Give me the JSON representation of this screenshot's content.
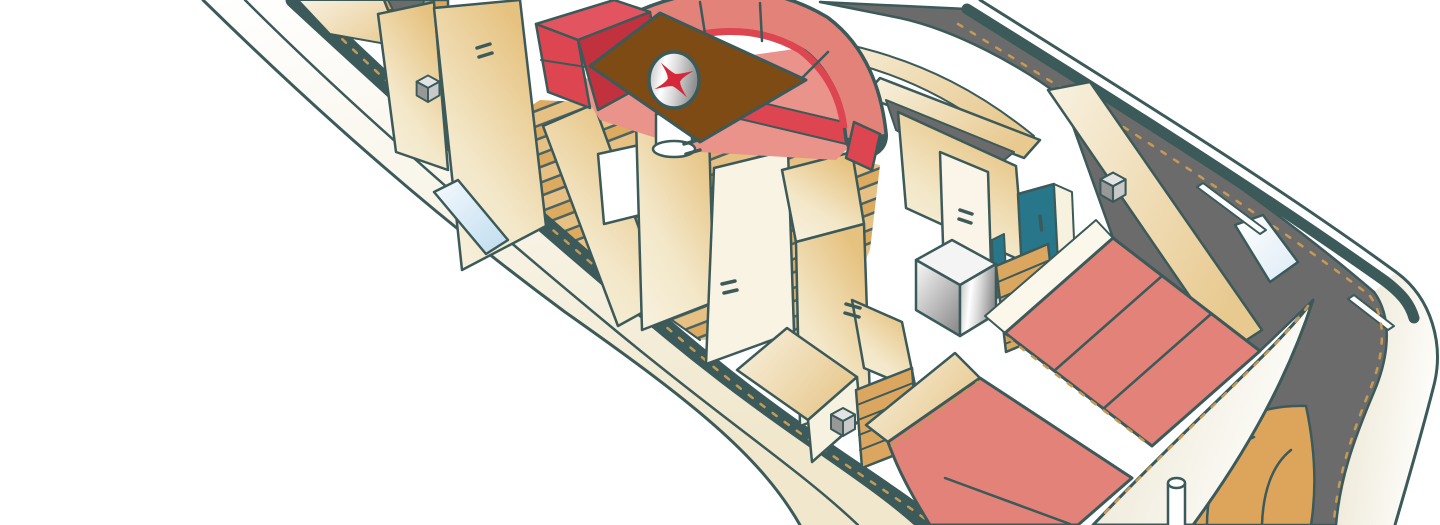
{
  "illustration": {
    "type": "isometric-cutaway",
    "subject": "yacht interior deck plan, bow at upper-left and stern at lower-right",
    "width_px": 1440,
    "height_px": 525,
    "visible_text": []
  },
  "palette": {
    "ink": "#3c5a5a",
    "hull_white": "#ffffff",
    "hull_cream": "#f3ecd6",
    "deck_gray": "#6b6b6b",
    "stripe_red": "#d0233a",
    "sofa_red": "#dd4550",
    "sofa_red_dark": "#c2323e",
    "sofa_red_top": "#e25560",
    "cushion_salmon": "#e28279",
    "seat_salmon": "#e9938b",
    "wall_cream": "#f7f1df",
    "wall_tan": "#e6c280",
    "wood_light": "#e7c183",
    "wood_mid": "#ddab60",
    "ladder_tan": "#dba760",
    "arc_tan": "#dda45c",
    "table_brown": "#7d4b13",
    "compass_red": "#d5293b",
    "teal": "#27768a",
    "window_blue": "#bfdcef",
    "steel_light": "#f2f2f2",
    "steel_dark": "#8f8f8f",
    "dash_tan": "#c59a55",
    "cube_gray": "#c9c9c9"
  },
  "regions": {
    "bow_forward_cabin": [
      "companionway-steps",
      "deck-hatch-cube",
      "cabin-door",
      "hull-window"
    ],
    "salon": [
      "curved-settee",
      "settee-arm",
      "dinette-table",
      "compass-rose-inlay",
      "table-pedestal",
      "teak-plank-floor"
    ],
    "midship": [
      "passage-doors",
      "door-handles",
      "lower-step-well",
      "cabinet",
      "companion-ladder",
      "deck-hatch-cube"
    ],
    "galley_head": [
      "beam",
      "cockpit-well",
      "stainless-sink-unit",
      "teal-door",
      "aft-steps",
      "deck-hatch-cube"
    ],
    "aft_cabin": [
      "double-berth",
      "port-berth",
      "berth-seams",
      "curved-coaming"
    ],
    "aft_deck": [
      "side-deck",
      "deck-windows",
      "curved-transom-steps",
      "flag-pole"
    ],
    "hull": [
      "sheer-stripe-port",
      "sheer-stripe-starboard",
      "gunwale-band",
      "stern-quarter"
    ]
  },
  "icons": [
    {
      "name": "hatch-cube-icon",
      "count": 3
    },
    {
      "name": "compass-rose-icon",
      "count": 1
    },
    {
      "name": "door-handle-icon",
      "count": 6
    },
    {
      "name": "flag-pole-icon",
      "count": 1
    }
  ]
}
